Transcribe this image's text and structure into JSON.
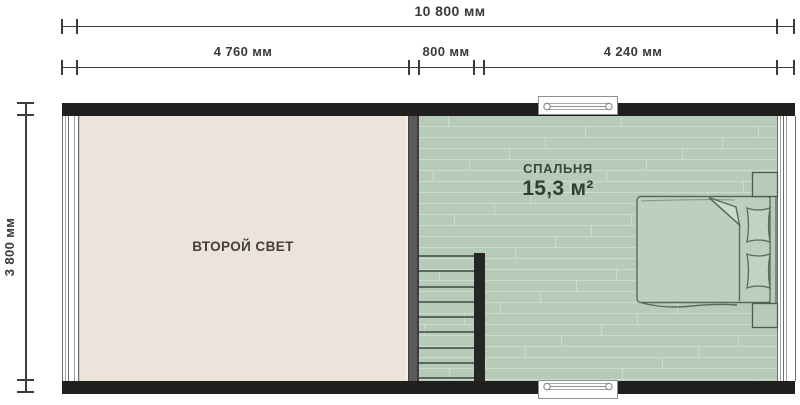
{
  "plan": {
    "dimensions": {
      "total_width_label": "10 800 мм",
      "segment_labels": [
        "4 760 мм",
        "800 мм",
        "4 240 мм"
      ],
      "height_label": "3 800 мм"
    },
    "rooms": {
      "second_light": {
        "name": "ВТОРОЙ СВЕТ"
      },
      "bedroom": {
        "name": "СПАЛЬНЯ",
        "area": "15,3 м²"
      }
    },
    "stairs": {
      "tread_count": 9
    },
    "floor_texture": {
      "plank_rows": 25,
      "joints_per_row": 2,
      "row_height": 11
    }
  },
  "colors": {
    "wall": "#201f1d",
    "partition": "#5a5a5d",
    "floor_second_light": "#ece3da",
    "floor_bedroom": "#b7cbb9",
    "dimension": "#3c3c3c",
    "furniture_stroke": "#5a695e"
  }
}
